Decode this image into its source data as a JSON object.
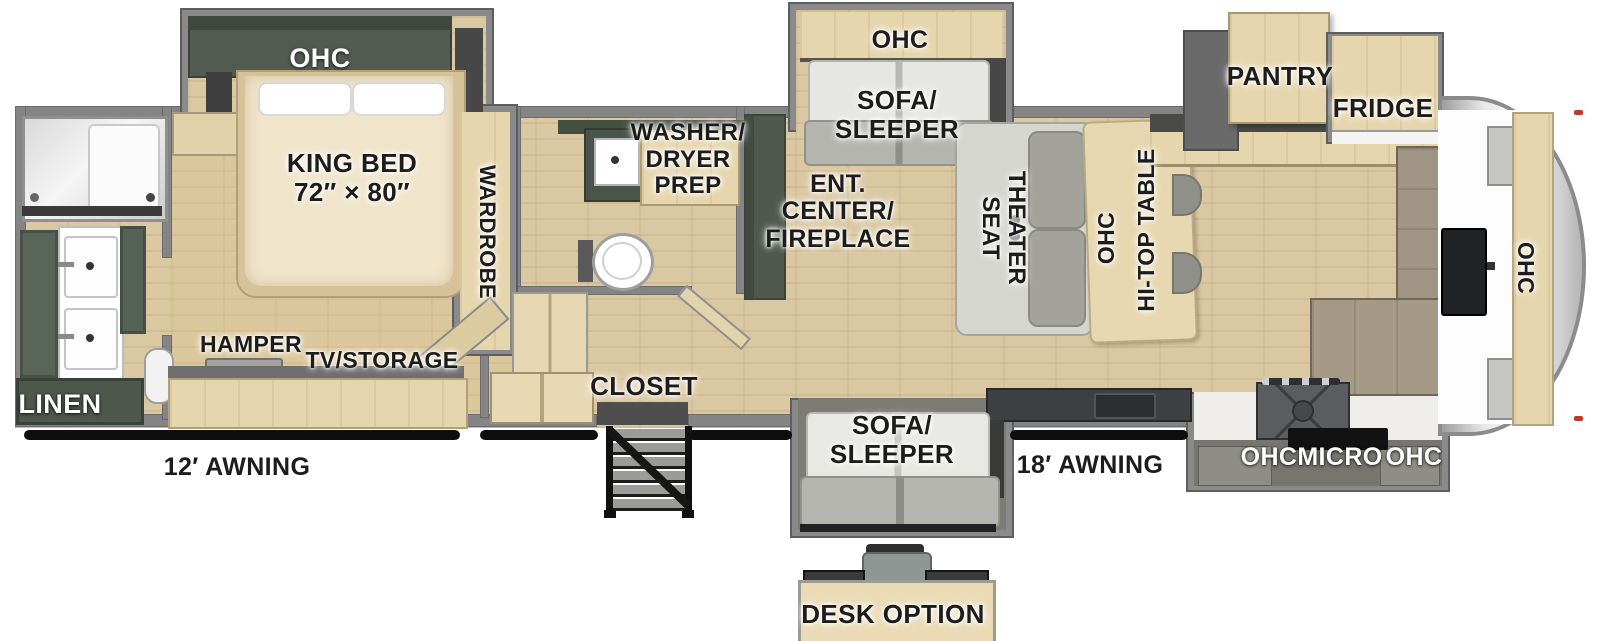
{
  "labels": {
    "bedroom": {
      "ohc": "OHC",
      "king_bed_l1": "KING BED",
      "king_bed_l2": "72″ × 80″",
      "wardrobe": "WARDROBE",
      "hamper": "HAMPER",
      "tv_storage": "TV/STORAGE"
    },
    "bathroom": {
      "linen": "LINEN",
      "washer_l1": "WASHER/",
      "washer_l2": "DRYER",
      "washer_l3": "PREP"
    },
    "mid": {
      "closet": "CLOSET",
      "ent_l1": "ENT.",
      "ent_l2": "CENTER/",
      "ent_l3": "FIREPLACE",
      "sofa_top_ohc": "OHC",
      "sofa_top_l1": "SOFA/",
      "sofa_top_l2": "SLEEPER",
      "theater_l1": "THEATER",
      "theater_l2": "SEAT",
      "dinette_ohc": "OHC",
      "hitop_table": "HI-TOP TABLE"
    },
    "kitchen": {
      "pantry": "PANTRY",
      "fridge": "FRIDGE",
      "front_ohc": "OHC",
      "ohc_left": "OHC",
      "micro": "MICRO",
      "ohc_right": "OHC"
    },
    "bottom": {
      "sofa_l1": "SOFA/",
      "sofa_l2": "SLEEPER",
      "awning12": "12′ AWNING",
      "awning18": "18′ AWNING",
      "desk_option": "DESK OPTION"
    }
  },
  "colors": {
    "floor_wood": "#dac8a2",
    "cabinet_wood": "#e6d6ae",
    "dark_green_cabinet": "#4f594d",
    "wall_gray": "#848484",
    "counter_dark": "#3e4144",
    "sofa_light": "#d6d6d0",
    "sofa_dark": "#a3a39c",
    "awning_black": "#0e0e0e",
    "front_cap_silver": "#d9d9d9",
    "label_black": "#1c1c1c",
    "label_white": "#ffffff"
  }
}
